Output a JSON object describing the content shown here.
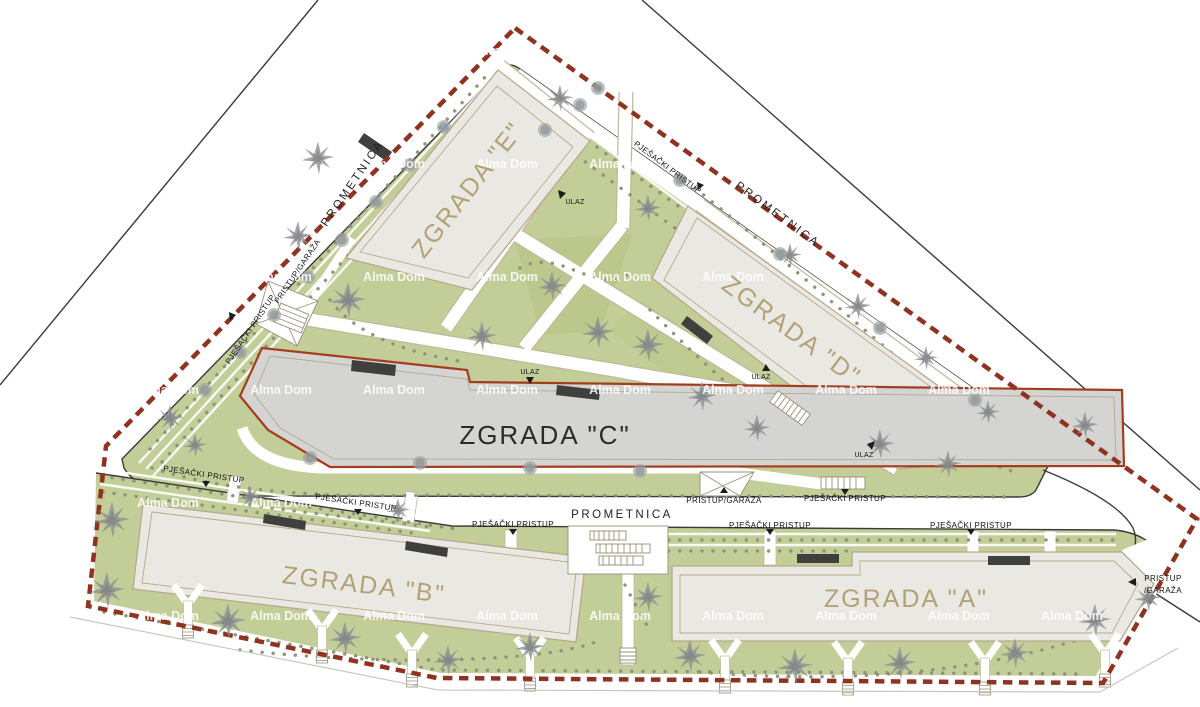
{
  "plan": {
    "watermark": "Alma Dom",
    "labels": {
      "road": "PROMETNICA",
      "pedestrian_access": "PJEŠAČKI PRISTUP",
      "garage_access": "PRISTUP/GARAŽA",
      "garage_access_line1": "PRISTUP",
      "garage_access_line2": "/GARAŽA",
      "entrance": "ULAZ"
    },
    "buildings": [
      {
        "id": "A",
        "label": "ZGRADA \"A\""
      },
      {
        "id": "B",
        "label": "ZGRADA \"B\""
      },
      {
        "id": "C",
        "label": "ZGRADA \"C\""
      },
      {
        "id": "D",
        "label": "ZGRADA \"D\""
      },
      {
        "id": "E",
        "label": "ZGRADA \"E\""
      }
    ],
    "colors": {
      "boundary_dash": "#8f3320",
      "greenery": "#c3cd97",
      "building_fill": "#eae8e3",
      "building_c_fill": "#d4d4d2",
      "building_outline": "#b9a98c",
      "building_c_outline": "#a33d1e",
      "building_label_text": "#b3a176",
      "road_line": "#3a3a3a",
      "tree": "#8d9093",
      "canopy": "#3f3f3d",
      "watermark_text": "#ffffff"
    }
  }
}
